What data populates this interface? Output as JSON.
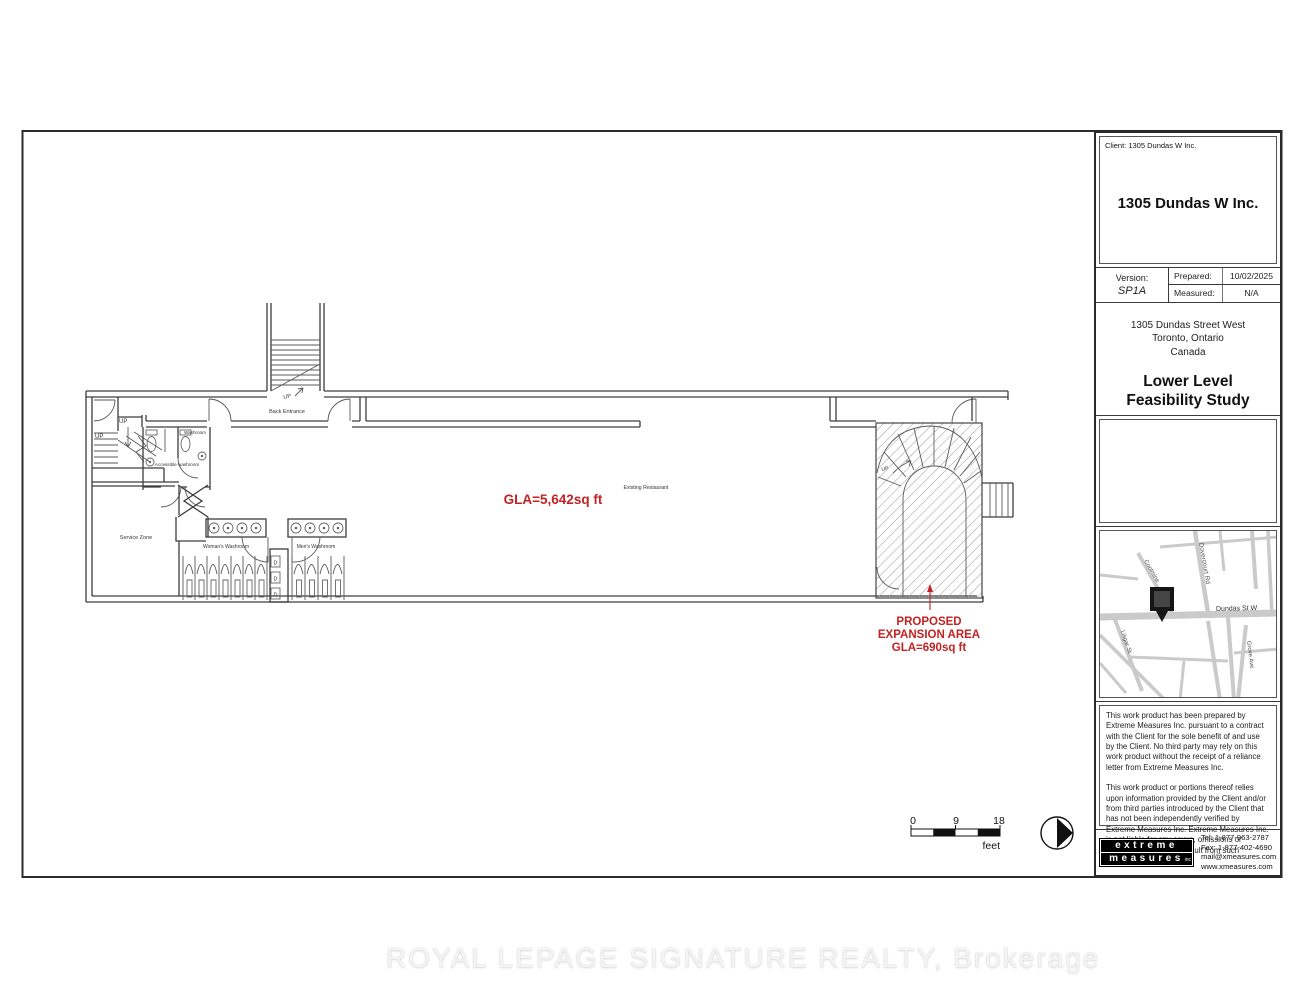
{
  "document": {
    "watermark": "ROYAL LEPAGE SIGNATURE REALTY, Brokerage"
  },
  "plan": {
    "labels": {
      "up": "UP",
      "back_entrance": "Back Entrance",
      "washroom": "Washroom",
      "accessible_washroom": "Accessible washroom",
      "service_zone": "Service Zone",
      "womens_washroom": "Woman's Washroom",
      "mens_washroom": "Men's Washroom",
      "existing_restaurant": "Existing Restaurant",
      "drain": "D"
    },
    "annotations": {
      "gla_main": "GLA=5,642sq ft",
      "proposed_line1": "PROPOSED",
      "proposed_line2": "EXPANSION AREA",
      "proposed_line3": "GLA=690sq ft",
      "red": "#c32222"
    },
    "scale_bar": {
      "ticks": [
        "0",
        "9",
        "18"
      ],
      "unit": "feet"
    }
  },
  "title_block": {
    "client_line": "Client: 1305 Dundas W Inc.",
    "client_name": "1305 Dundas W Inc.",
    "version_label": "Version:",
    "version_value": "SP1A",
    "prepared_label": "Prepared:",
    "prepared_value": "10/02/2025",
    "measured_label": "Measured:",
    "measured_value": "N/A",
    "address_line1": "1305 Dundas Street West",
    "address_line2": "Toronto, Ontario",
    "address_line3": "Canada",
    "study_line1": "Lower Level",
    "study_line2": "Feasibility Study",
    "map": {
      "streets": [
        "Dovercourt Rd",
        "Coolmine",
        "Lisgar St",
        "Grove Ave",
        "Dundas St W"
      ]
    },
    "disclaimer_p1": "This work product has been prepared by Extreme Measures Inc. pursuant to a contract with the Client for the sole benefit of and use by the Client. No third party may rely on this work product without the receipt of a reliance letter from Extreme Measures Inc.",
    "disclaimer_p2": "This work product or portions thereof relies upon information provided by the Client and/or from third parties introduced by the Client that has not been independently verified by Extreme Measures Inc. Extreme Measures Inc. is not liable for any errors, omissions or inaccuracies that may result from such information.",
    "logo": {
      "word1": "extreme",
      "word2": "measures",
      "suffix": "inc"
    },
    "contact": {
      "tel": "Tel:  1-877-963-2787",
      "fax": "Fax: 1-877-402-4690",
      "email": "mail@xmeasures.com",
      "web": "www.xmeasures.com"
    }
  }
}
